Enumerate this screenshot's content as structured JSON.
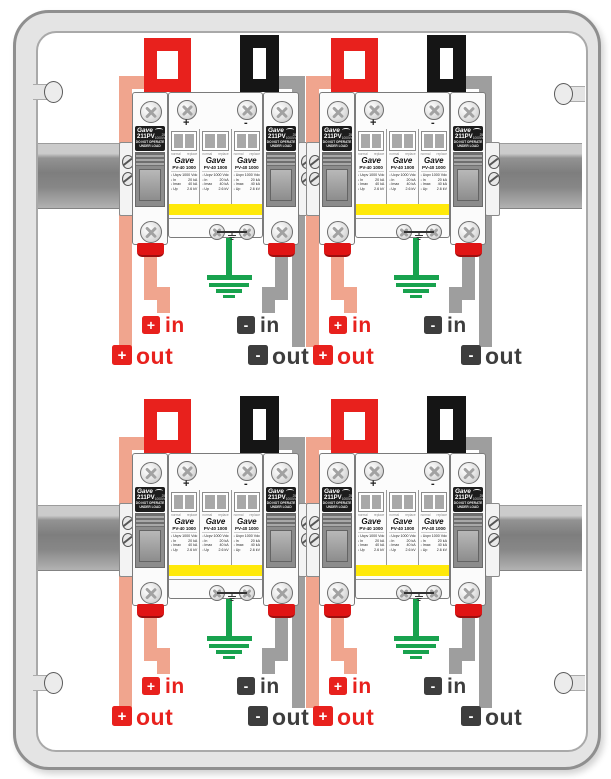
{
  "colors": {
    "wire_red": "#e8211d",
    "wire_black": "#151515",
    "wire_salmon": "#f0a58e",
    "wire_gray": "#9e9e9e",
    "wire_green": "#18a24e",
    "label_red": "#e8211d",
    "label_dark": "#3d3d3d",
    "yellow_band": "#ffe90a",
    "terminal_red": "#e01414",
    "enclosure_fill": "#e4e4e4"
  },
  "units": [
    {
      "position": "top-left"
    },
    {
      "position": "top-right"
    },
    {
      "position": "bottom-left"
    },
    {
      "position": "bottom-right"
    }
  ],
  "device": {
    "fuse_holder": {
      "brand": "Gave",
      "model": "211PV",
      "rating_top": "25A",
      "rating_bottom": "1000Vdc",
      "warning_line1": "DO NOT OPERATE",
      "warning_line2": "UNDER LOAD"
    },
    "spd": {
      "brand": "Gave",
      "model": "PV-40 1000",
      "plus_sign": "+",
      "minus_sign": "-",
      "indicator_left": "normal",
      "indicator_right": "replace",
      "specs": [
        {
          "k": "Ucpv",
          "v": "1000 Vdc"
        },
        {
          "k": "In",
          "v": "20 kA"
        },
        {
          "k": "Imax",
          "v": "40 kA"
        },
        {
          "k": "Up",
          "v": "2.6 kV"
        }
      ]
    }
  },
  "labels": {
    "pos_in": {
      "badge": "+",
      "text": "in"
    },
    "neg_in": {
      "badge": "-",
      "text": "in"
    },
    "pos_out": {
      "badge": "+",
      "text": "out"
    },
    "neg_out": {
      "badge": "-",
      "text": "out"
    }
  }
}
